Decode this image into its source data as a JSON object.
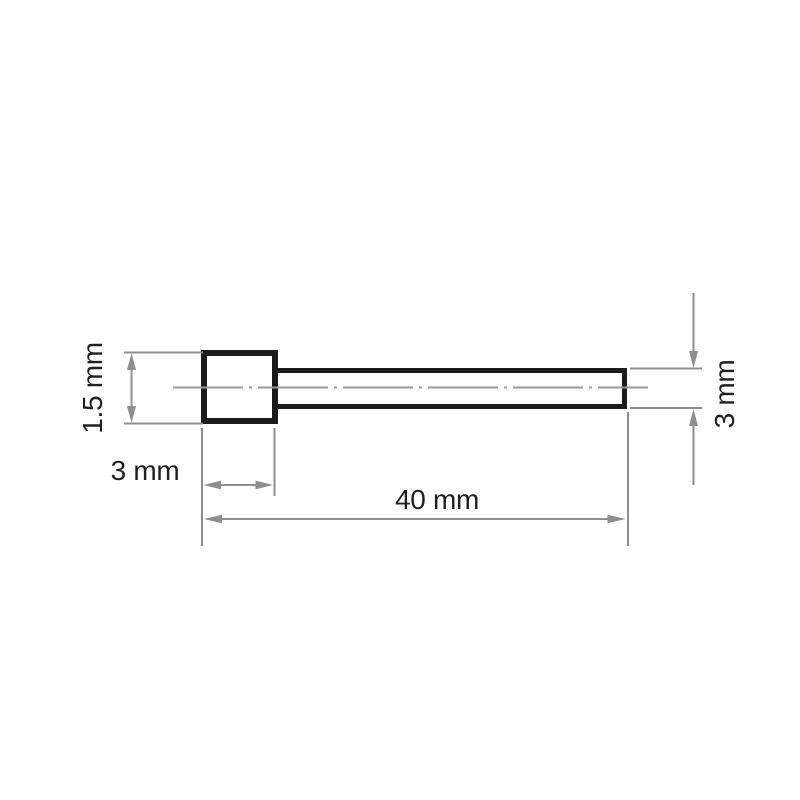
{
  "figure": {
    "type": "technical-drawing",
    "background": "#ffffff",
    "colors": {
      "outline": "#1b1b1b",
      "dimension": "#8e8e8e",
      "centerline": "#9a9a9a",
      "text": "#1f1f1f"
    },
    "dimensions": {
      "head_height": {
        "label": "1.5 mm"
      },
      "head_width": {
        "label": "3 mm"
      },
      "overall_length": {
        "label": "40 mm"
      },
      "shank_diameter": {
        "label": "3 mm"
      }
    }
  }
}
